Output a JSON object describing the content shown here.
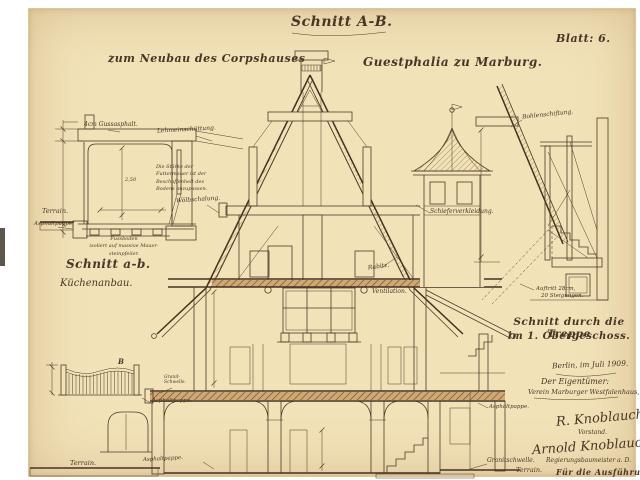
{
  "sheet": {
    "title": "Schnitt A-B.",
    "subtitle_left": "zum Neubau des Corpshauses",
    "subtitle_right": "Guestphalia zu Marburg.",
    "number": "Blatt: 6."
  },
  "kitchen_annex": {
    "title": "Schnitt a-b.",
    "subtitle": "Küchenanbau.",
    "labels": {
      "asphalt": "4cm Gussasphalt.",
      "fill": "Lehmeinschüttung.",
      "terrain": "Terrain.",
      "asphalt_felt": "Asphaltpappe.",
      "dim_room_height": "2,50"
    },
    "note_lines": [
      "Die Stärke der",
      "Futtermauer ist der",
      "Beschaffenheit des",
      "Bodens anzupassen."
    ],
    "floor_note_lines": [
      "Fussboden",
      "isoliert auf massive Mauer-",
      "steinpfeiler."
    ]
  },
  "main_section": {
    "labels": {
      "formwork": "Wölbschalung.",
      "slate": "Schieferverkleidung.",
      "rabitz": "Rabitz.",
      "ventilation": "Ventilation.",
      "asphalt_felt_upper": "Asphaltpappe.",
      "asphalt_felt_lower": "Asphaltpappe.",
      "asphalt_felt_right": "Asphaltpappe.",
      "granite_sill_line1": "Granit-",
      "granite_sill_line2": "Schwelle.",
      "terrain_left": "Terrain.",
      "granite_sill": "Granitschwelle.",
      "terrain_right": "Terrain.",
      "section_marker": "B"
    }
  },
  "stair_section": {
    "title_line1": "Schnitt durch die Treppe",
    "title_line2": "im 1. Obergeschoss.",
    "labels": {
      "plank": "Bohlenschiftung.",
      "tread": "Auftritt 28cm,",
      "risers": "20 Steigungen."
    }
  },
  "signature_block": {
    "place_date": "Berlin, im Juli 1909.",
    "owner_heading": "Der Eigentümer:",
    "owner_name": "Verein Marburger Westfalenhaus, E.V.",
    "signature_1": "R. Knoblauch",
    "signature_1_role": "Vorstand.",
    "signature_2": "Arnold Knoblauch",
    "signature_2_role": "Regierungsbaumeister a. D.",
    "execution_heading": "Für die Ausführung:"
  },
  "colors": {
    "paper": "#f2e2b8",
    "ink": "#4a3526",
    "masonry": "#cfa973",
    "dark_masonry": "#8a6840"
  }
}
